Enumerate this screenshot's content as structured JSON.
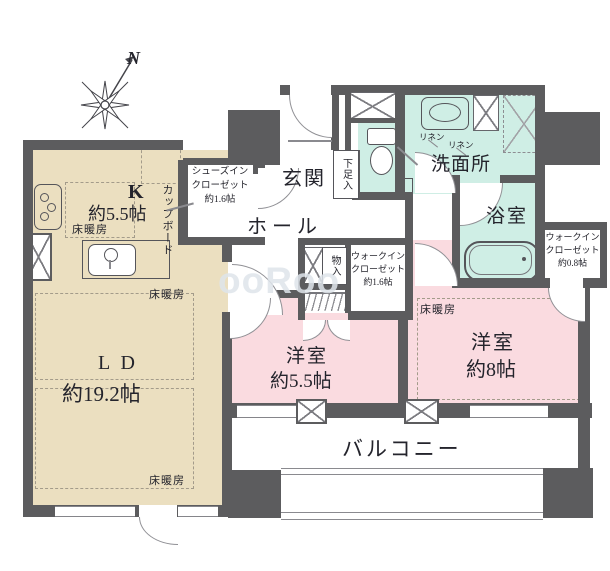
{
  "compass": {
    "north_label": "N"
  },
  "watermark": "ooRoo",
  "colors": {
    "wall": "#5c5c5e",
    "kitchen_ld_floor": "#ebdfc0",
    "bedroom_floor": "#fadbe0",
    "wet_area_floor": "#cfeee5",
    "door_arc_line": "#909095"
  },
  "rooms": {
    "kitchen": {
      "label": "K",
      "size": "約5.5帖",
      "floor_heating": "床暖房",
      "cupboard": "カップボード"
    },
    "living_dining": {
      "label": "L D",
      "size": "約19.2帖",
      "floor_heating_top": "床暖房",
      "floor_heating_bottom": "床暖房"
    },
    "entrance": {
      "label": "玄関"
    },
    "hall": {
      "label": "ホール"
    },
    "shoe_box": {
      "label": "下足入"
    },
    "shoes_in_closet": {
      "lines": [
        "シューズイン",
        "クローゼット",
        "約1.6帖"
      ]
    },
    "washroom": {
      "label": "洗面所",
      "linen_left": "リネン",
      "linen_right": "リネン"
    },
    "bathroom": {
      "label": "浴室"
    },
    "walk_in_closet_08": {
      "lines": [
        "ウォークイン",
        "クローゼット",
        "約0.8帖"
      ]
    },
    "walk_in_closet_16": {
      "lines": [
        "ウォークイン",
        "クローゼット",
        "約1.6帖"
      ]
    },
    "storage": {
      "label": "物入"
    },
    "western_room_55": {
      "label": "洋室",
      "size": "約5.5帖"
    },
    "western_room_8": {
      "label": "洋室",
      "size": "約8帖",
      "floor_heating": "床暖房"
    },
    "balcony": {
      "label": "バルコニー"
    }
  }
}
